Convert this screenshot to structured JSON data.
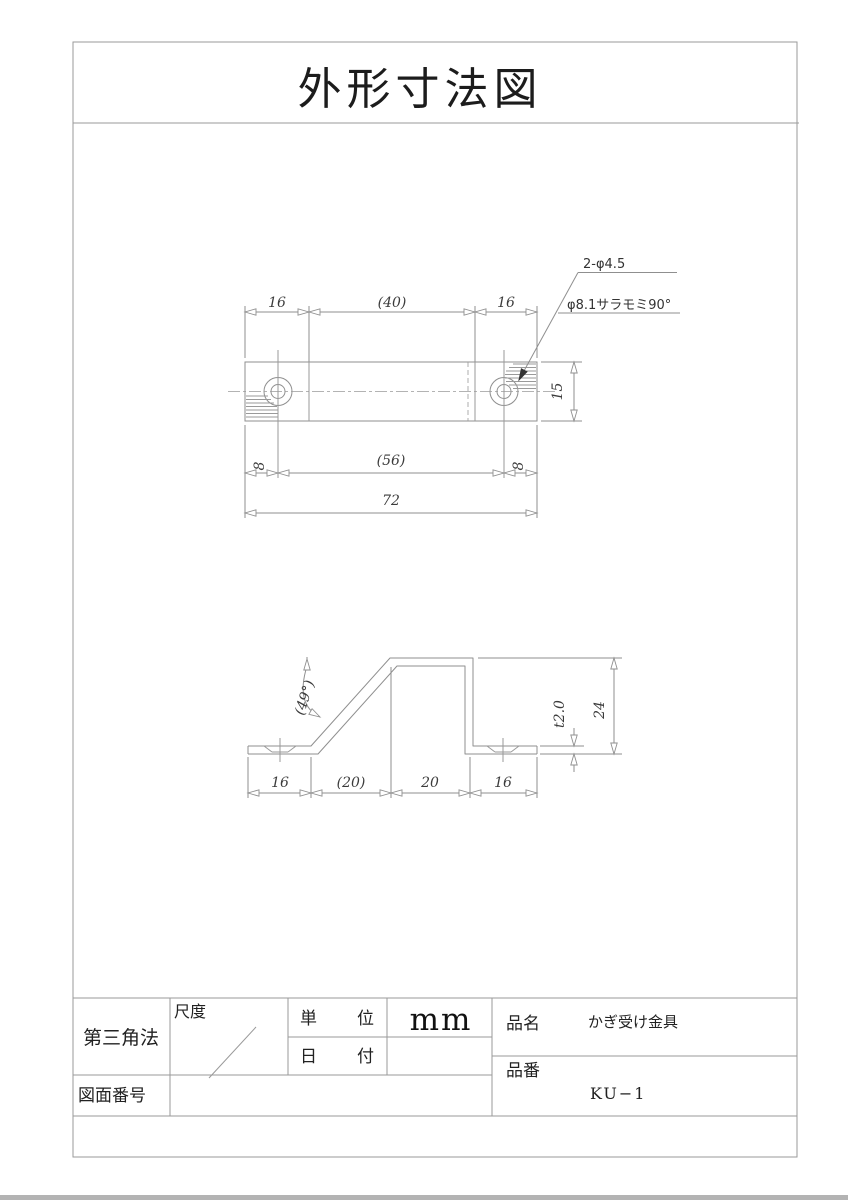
{
  "page": {
    "title": "外形寸法図"
  },
  "callout": {
    "holes": "2-φ4.5",
    "countersink": "φ8.1サラモミ90°"
  },
  "top_view": {
    "dim_left": "16",
    "dim_mid": "(40)",
    "dim_right": "16",
    "dim_height": "15",
    "dim_off_left": "8",
    "dim_span": "(56)",
    "dim_off_right": "8",
    "dim_total": "72"
  },
  "side_view": {
    "dim_angle": "(49°)",
    "dim_thickness": "t2.0",
    "dim_height": "24",
    "dim_1": "16",
    "dim_2": "(20)",
    "dim_3": "20",
    "dim_4": "16"
  },
  "title_block": {
    "projection": "第三角法",
    "scale_label": "尺度",
    "unit_label": "単位",
    "unit_value": "mm",
    "date_label": "日付",
    "date_value": "",
    "drawing_no_label": "図面番号",
    "drawing_no_value": "",
    "name_label": "品名",
    "name_value": "かぎ受け金具",
    "number_label": "品番",
    "number_value": "KU−1"
  },
  "colors": {
    "line": "#9a9a9a",
    "text": "#333333"
  }
}
